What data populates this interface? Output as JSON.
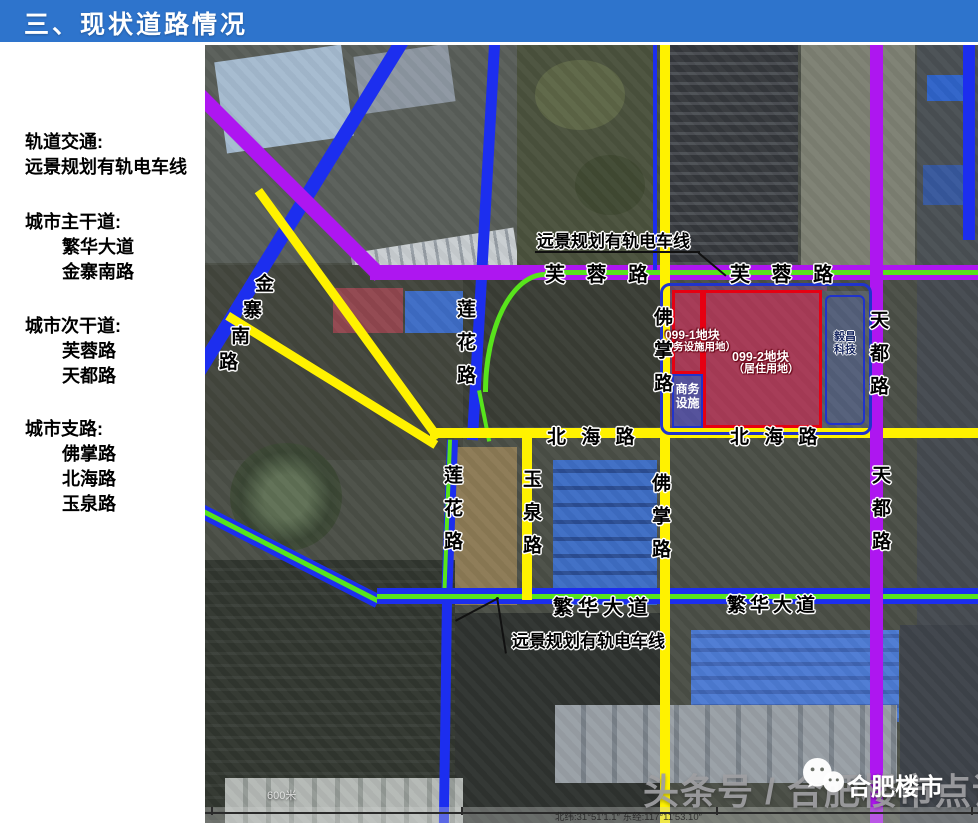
{
  "header": {
    "title": "三、现状道路情况"
  },
  "sidebar": {
    "rail_heading": "轨道交通:",
    "rail_item": "远景规划有轨电车线",
    "arterial_heading": "城市主干道:",
    "arterial_items": [
      "繁华大道",
      "金寨南路"
    ],
    "secondary_heading": "城市次干道:",
    "secondary_items": [
      "芙蓉路",
      "天都路"
    ],
    "branch_heading": "城市支路:",
    "branch_items": [
      "佛掌路",
      "北海路",
      "玉泉路"
    ]
  },
  "map": {
    "tram_label_top": "远景规划有轨电车线",
    "tram_label_bottom": "远景规划有轨电车线",
    "furong_left": "芙 蓉 路",
    "furong_right": "芙 蓉 路",
    "beihai_left": "北 海 路",
    "beihai_right": "北 海 路",
    "fanhua_left": "繁华大道",
    "fanhua_right": "繁华大道",
    "jinzhai_chars": [
      "金",
      "寨",
      "南",
      "路"
    ],
    "lianhua_north": "莲花路",
    "lianhua_south": "莲花路",
    "yuquan": "玉泉路",
    "fozhang_north": "佛掌路",
    "fozhang_south": "佛掌路",
    "tiandu_north": "天都路",
    "tiandu_south": "天都路",
    "parcel1_title": "099-1地块",
    "parcel1_sub": "（商务设施用地）",
    "parcel2_title": "099-2地块",
    "parcel2_sub": "（居住用地）",
    "biz_line1": "商务",
    "biz_line2": "设施",
    "company_line1": "毅昌",
    "company_line2": "科技",
    "scale_label": "600米",
    "coords_label": "北纬:31°51'1.1″   东经:117°11'53.10″"
  },
  "watermark": {
    "byline": "头条号 / 合肥楼市点评",
    "wechat_name": "合肥楼市"
  },
  "colors": {
    "header_bg": "#2E74CC",
    "tram_green": "#58E41C",
    "main_road_blue": "#1C2EEF",
    "secondary_road_purple": "#AE16F0",
    "branch_road_yellow": "#FFF200",
    "parcel_border_red": "#E60012",
    "zone_border_blue": "#2033CC"
  }
}
